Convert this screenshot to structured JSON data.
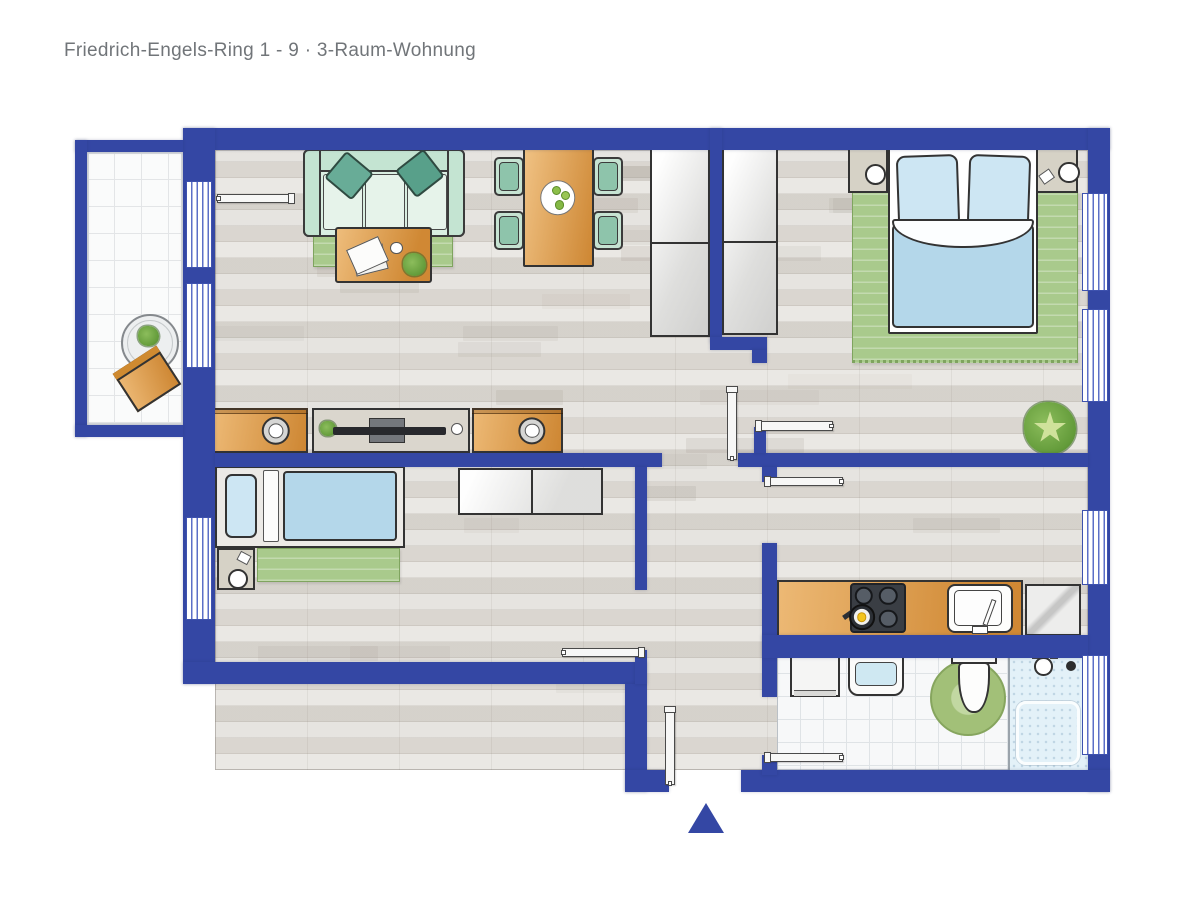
{
  "title": "Friedrich-Engels-Ring 1 - 9 · 3-Raum-Wohnung",
  "colors": {
    "wall_blue": "#3447a4",
    "window_stripe_blue": "#5b6fc7",
    "accent_orange": "#e0973d",
    "sofa_mint": "#d9eee1",
    "cushion_teal": "#63a893",
    "rug_green": "#a9ca8c",
    "bed_blue": "#b4d7ea",
    "floor_wood": "#e1ded9",
    "tile_white": "#f7f8f9",
    "title_gray": "#717579"
  },
  "plan": {
    "canvas": {
      "w": 1200,
      "h": 900
    },
    "floors": [
      {
        "name": "floor-main",
        "type": "wood",
        "x": 215,
        "y": 150,
        "w": 873,
        "h": 620
      },
      {
        "name": "floor-balcony",
        "type": "tile-lg",
        "x": 87,
        "y": 152,
        "w": 96,
        "h": 273
      },
      {
        "name": "floor-bathroom",
        "type": "tile",
        "x": 777,
        "y": 650,
        "w": 311,
        "h": 120
      }
    ],
    "walls": [
      {
        "name": "wall-top",
        "x": 183,
        "y": 128,
        "w": 927,
        "h": 22
      },
      {
        "name": "wall-right",
        "x": 1088,
        "y": 128,
        "w": 22,
        "h": 664
      },
      {
        "name": "wall-left",
        "x": 183,
        "y": 128,
        "w": 32,
        "h": 556
      },
      {
        "name": "wall-kids-bottom",
        "x": 183,
        "y": 662,
        "w": 464,
        "h": 22
      },
      {
        "name": "wall-vestibule-left",
        "x": 625,
        "y": 684,
        "w": 22,
        "h": 108
      },
      {
        "name": "wall-bottom-left",
        "x": 625,
        "y": 770,
        "w": 44,
        "h": 22
      },
      {
        "name": "wall-bottom-right",
        "x": 741,
        "y": 770,
        "w": 369,
        "h": 22
      },
      {
        "name": "wall-living-kids",
        "x": 215,
        "y": 453,
        "w": 447,
        "h": 14
      },
      {
        "name": "wall-kids-right-upper",
        "x": 635,
        "y": 467,
        "w": 12,
        "h": 123
      },
      {
        "name": "wall-kids-right-lower",
        "x": 635,
        "y": 650,
        "w": 12,
        "h": 34
      },
      {
        "name": "wall-living-bedroom",
        "x": 710,
        "y": 128,
        "w": 12,
        "h": 215
      },
      {
        "name": "wall-lb-foot",
        "x": 710,
        "y": 337,
        "w": 57,
        "h": 13
      },
      {
        "name": "wall-lb-tab",
        "x": 752,
        "y": 350,
        "w": 15,
        "h": 13
      },
      {
        "name": "wall-bedroom-hall",
        "x": 738,
        "y": 453,
        "w": 350,
        "h": 14
      },
      {
        "name": "wall-hall-stub-up",
        "x": 754,
        "y": 427,
        "w": 12,
        "h": 26
      },
      {
        "name": "wall-hall-stub-down",
        "x": 762,
        "y": 467,
        "w": 15,
        "h": 15
      },
      {
        "name": "wall-kitchen-left",
        "x": 762,
        "y": 543,
        "w": 15,
        "h": 154
      },
      {
        "name": "wall-kitchen-bath",
        "x": 762,
        "y": 635,
        "w": 326,
        "h": 23
      },
      {
        "name": "wall-bath-door-stub",
        "x": 762,
        "y": 755,
        "w": 15,
        "h": 20
      },
      {
        "name": "wall-balcony-top",
        "x": 75,
        "y": 140,
        "w": 108,
        "h": 12
      },
      {
        "name": "wall-balcony-left",
        "x": 75,
        "y": 140,
        "w": 12,
        "h": 297
      },
      {
        "name": "wall-balcony-bottom",
        "x": 75,
        "y": 425,
        "w": 108,
        "h": 12
      }
    ],
    "windows": [
      {
        "name": "window-living-1",
        "x": 186,
        "y": 181,
        "w": 26,
        "h": 87
      },
      {
        "name": "window-living-2",
        "x": 186,
        "y": 283,
        "w": 26,
        "h": 85
      },
      {
        "name": "window-kids",
        "x": 186,
        "y": 517,
        "w": 26,
        "h": 103
      },
      {
        "name": "window-bedroom-1",
        "x": 1082,
        "y": 193,
        "w": 26,
        "h": 98
      },
      {
        "name": "window-bedroom-2",
        "x": 1082,
        "y": 309,
        "w": 26,
        "h": 93
      },
      {
        "name": "window-kitchen",
        "x": 1082,
        "y": 510,
        "w": 26,
        "h": 75
      },
      {
        "name": "window-bathroom",
        "x": 1082,
        "y": 655,
        "w": 26,
        "h": 100
      }
    ],
    "doors": [
      {
        "name": "door-balcony",
        "x": 217,
        "y": 194,
        "w": 76,
        "h": 9,
        "hinge": "end"
      },
      {
        "name": "door-hall",
        "x": 727,
        "y": 388,
        "w": 10,
        "h": 72,
        "hinge": "start"
      },
      {
        "name": "door-bedroom",
        "x": 757,
        "y": 421,
        "w": 76,
        "h": 10,
        "hinge": "start"
      },
      {
        "name": "door-kitchen",
        "x": 766,
        "y": 477,
        "w": 77,
        "h": 9,
        "hinge": "start"
      },
      {
        "name": "door-kids",
        "x": 562,
        "y": 648,
        "w": 81,
        "h": 9,
        "hinge": "end"
      },
      {
        "name": "door-bathroom",
        "x": 766,
        "y": 753,
        "w": 77,
        "h": 9,
        "hinge": "start"
      },
      {
        "name": "door-entrance",
        "x": 665,
        "y": 708,
        "w": 10,
        "h": 77,
        "hinge": "start"
      }
    ],
    "furniture": [
      {
        "name": "living-rug",
        "type": "rug",
        "x": 313,
        "y": 203,
        "w": 140,
        "h": 64
      },
      {
        "name": "sofa",
        "type": "sofa",
        "x": 303,
        "y": 149,
        "w": 162,
        "h": 88
      },
      {
        "name": "coffee-table",
        "type": "coffee-table",
        "x": 335,
        "y": 227,
        "w": 97,
        "h": 56
      },
      {
        "name": "dining-chair-top-left",
        "type": "chair",
        "x": 494,
        "y": 157,
        "w": 30,
        "h": 39
      },
      {
        "name": "dining-chair-bottom-left",
        "type": "chair",
        "x": 494,
        "y": 211,
        "w": 30,
        "h": 39
      },
      {
        "name": "dining-chair-top-right",
        "type": "chair",
        "x": 593,
        "y": 157,
        "w": 30,
        "h": 39
      },
      {
        "name": "dining-chair-bottom-right",
        "type": "chair",
        "x": 593,
        "y": 211,
        "w": 30,
        "h": 39
      },
      {
        "name": "dining-table",
        "type": "dining-table",
        "x": 523,
        "y": 148,
        "w": 71,
        "h": 119
      },
      {
        "name": "wardrobe-living",
        "type": "wardrobe",
        "x": 650,
        "y": 147,
        "w": 60,
        "h": 190
      },
      {
        "name": "wardrobe-bedroom",
        "type": "wardrobe",
        "x": 722,
        "y": 147,
        "w": 56,
        "h": 188
      },
      {
        "name": "tv-cabinet-left",
        "type": "speaker-cabinet",
        "x": 213,
        "y": 408,
        "w": 95,
        "h": 45
      },
      {
        "name": "tv-board",
        "type": "tv-board",
        "x": 312,
        "y": 408,
        "w": 158,
        "h": 45
      },
      {
        "name": "tv-cabinet-right",
        "type": "speaker-cabinet",
        "x": 472,
        "y": 408,
        "w": 91,
        "h": 45
      },
      {
        "name": "bedroom-rug",
        "type": "rug-fringe",
        "x": 852,
        "y": 188,
        "w": 226,
        "h": 175
      },
      {
        "name": "nightstand-left",
        "type": "nightstand",
        "x": 848,
        "y": 148,
        "w": 40,
        "h": 45,
        "lamp": [
          0.42,
          0.36
        ]
      },
      {
        "name": "nightstand-right",
        "type": "nightstand",
        "x": 1036,
        "y": 148,
        "w": 42,
        "h": 45,
        "lamp": [
          0.52,
          0.3
        ],
        "card": [
          0.1,
          0.52,
          -35
        ]
      },
      {
        "name": "double-bed",
        "type": "bed-double",
        "x": 888,
        "y": 148,
        "w": 150,
        "h": 186
      },
      {
        "name": "bedroom-plant",
        "type": "plant",
        "x": 1024,
        "y": 402,
        "w": 52,
        "h": 52
      },
      {
        "name": "kids-rug",
        "type": "rug",
        "x": 257,
        "y": 548,
        "w": 143,
        "h": 34
      },
      {
        "name": "kids-bed",
        "type": "bed-single",
        "x": 215,
        "y": 466,
        "w": 190,
        "h": 82
      },
      {
        "name": "kids-nightstand",
        "type": "nightstand",
        "x": 217,
        "y": 548,
        "w": 38,
        "h": 42,
        "lamp": [
          0.3,
          0.5
        ],
        "card": [
          0.55,
          0.12,
          28
        ]
      },
      {
        "name": "kids-dresser",
        "type": "dresser",
        "x": 458,
        "y": 468,
        "w": 145,
        "h": 47
      },
      {
        "name": "kitchen-counter",
        "type": "counter",
        "x": 777,
        "y": 580,
        "w": 246,
        "h": 57
      },
      {
        "name": "stove",
        "type": "stove",
        "x": 850,
        "y": 583,
        "w": 56,
        "h": 50
      },
      {
        "name": "kitchen-sink",
        "type": "kitchen-sink",
        "x": 947,
        "y": 584,
        "w": 66,
        "h": 49
      },
      {
        "name": "fridge",
        "type": "fridge",
        "x": 1025,
        "y": 584,
        "w": 56,
        "h": 52
      },
      {
        "name": "washing-machine",
        "type": "washer",
        "x": 790,
        "y": 651,
        "w": 50,
        "h": 46
      },
      {
        "name": "bathroom-sink",
        "type": "bath-sink",
        "x": 848,
        "y": 650,
        "w": 56,
        "h": 46
      },
      {
        "name": "toilet-rug",
        "type": "round-rug",
        "x": 930,
        "y": 660,
        "w": 76,
        "h": 76
      },
      {
        "name": "toilet",
        "type": "toilet",
        "x": 950,
        "y": 650,
        "w": 48,
        "h": 64
      },
      {
        "name": "shower",
        "type": "shower",
        "x": 1008,
        "y": 650,
        "w": 80,
        "h": 122
      },
      {
        "name": "balcony-table",
        "type": "balcony-table",
        "x": 121,
        "y": 314,
        "w": 58,
        "h": 58
      },
      {
        "name": "balcony-chair",
        "type": "balcony-chair",
        "x": 121,
        "y": 356,
        "w": 52,
        "h": 46,
        "rot": -33
      }
    ],
    "entrance_arrow": {
      "x": 688,
      "y": 803,
      "w": 36,
      "h": 30
    }
  }
}
